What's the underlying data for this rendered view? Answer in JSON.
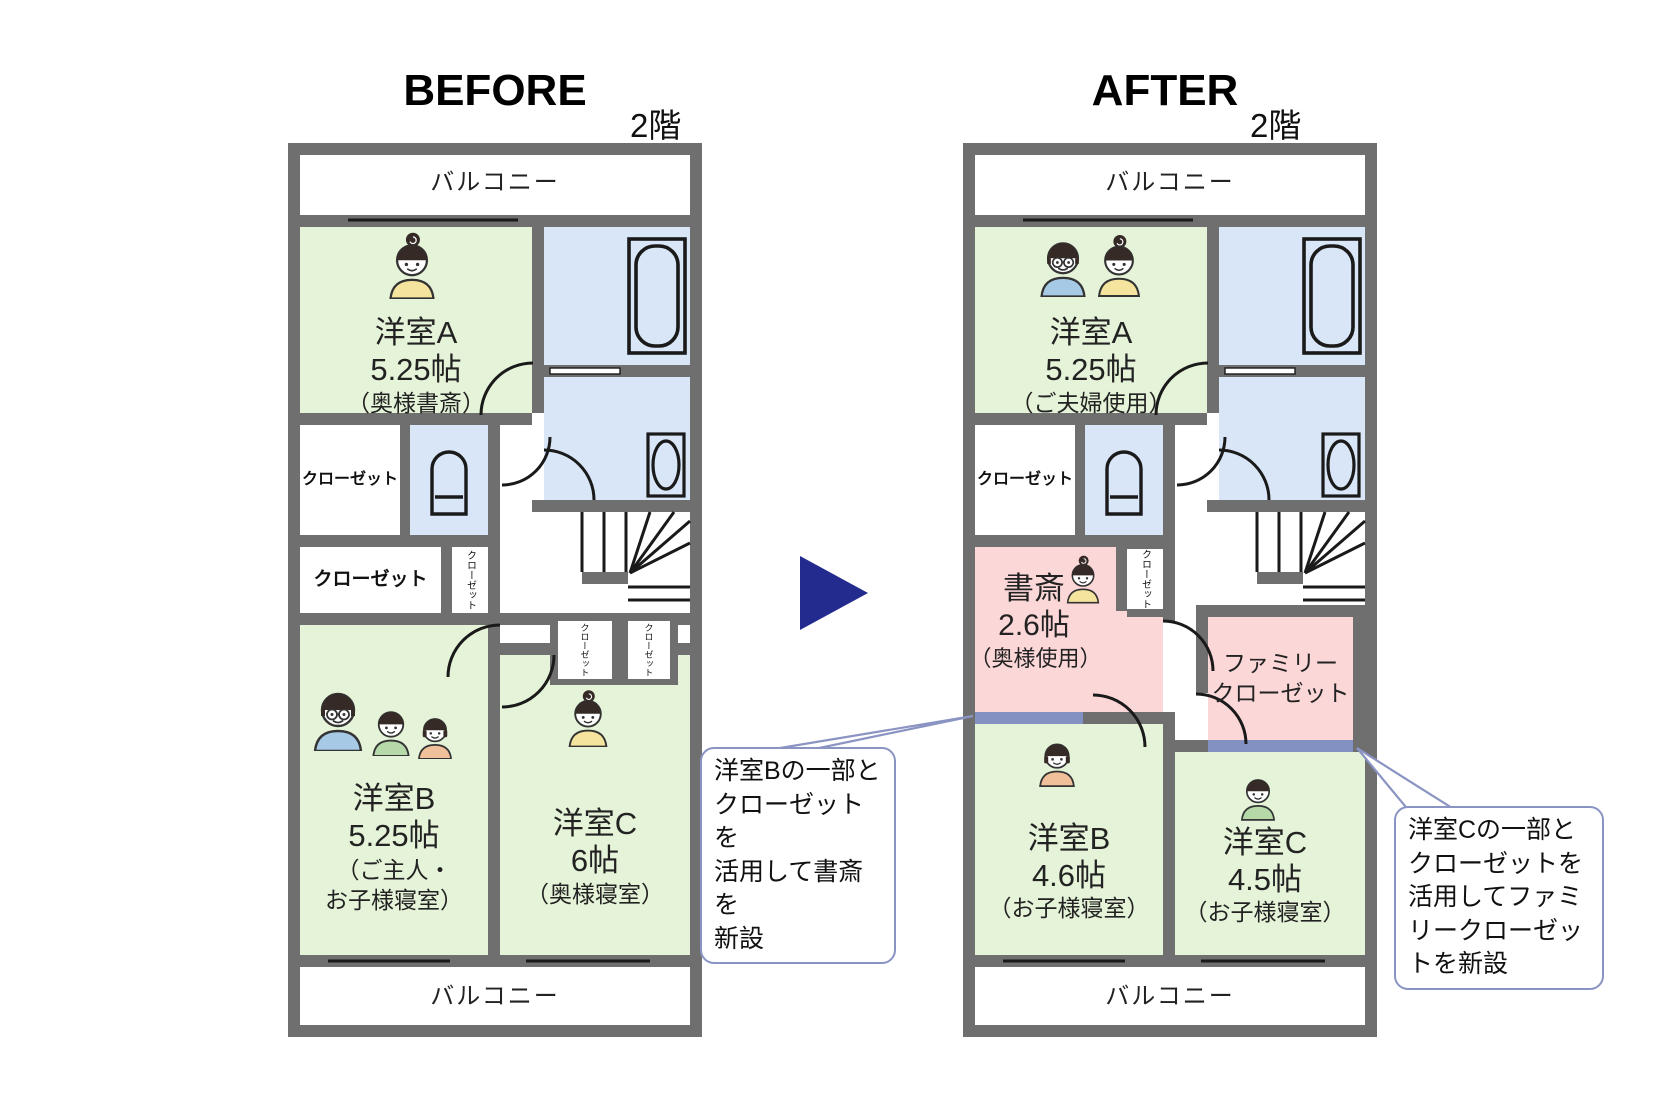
{
  "header": {
    "before_title": "BEFORE",
    "after_title": "AFTER",
    "floor_label_before": "2階",
    "floor_label_after": "2階"
  },
  "before": {
    "balcony_top": "バルコニー",
    "balcony_bottom": "バルコニー",
    "room_a_name": "洋室A",
    "room_a_size": "5.25帖",
    "room_a_note": "（奥様書斎）",
    "closet_upper": "クローゼット",
    "closet_lower": "クローゼット",
    "closet_hall": "クローゼット",
    "closet_c1": "クローゼット",
    "closet_c2": "クローゼット",
    "room_b_name": "洋室B",
    "room_b_size": "5.25帖",
    "room_b_note": "（ご主人・\nお子様寝室）",
    "room_c_name": "洋室C",
    "room_c_size": "6帖",
    "room_c_note": "（奥様寝室）"
  },
  "after": {
    "balcony_top": "バルコニー",
    "balcony_bottom": "バルコニー",
    "room_a_name": "洋室A",
    "room_a_size": "5.25帖",
    "room_a_note": "（ご夫婦使用）",
    "closet_upper": "クローゼット",
    "closet_hall": "クローゼット",
    "study_name": "書斎",
    "study_size": "2.6帖",
    "study_note": "（奥様使用）",
    "family_closet": "ファミリー\nクローゼット",
    "room_b_name": "洋室B",
    "room_b_size": "4.6帖",
    "room_b_note": "（お子様寝室）",
    "room_c_name": "洋室C",
    "room_c_size": "4.5帖",
    "room_c_note": "（お子様寝室）"
  },
  "callouts": {
    "left": "洋室Bの一部と\nクローゼットを\n活用して書斎を\n新設",
    "right": "洋室Cの一部と\nクローゼットを\n活用してファミ\nリークローゼッ\nトを新設"
  },
  "colors": {
    "room_green": "#e5f3d8",
    "water_blue": "#d9e6f7",
    "new_pink": "#fcd7d8",
    "wall_gray": "#6f6f6f",
    "new_wall_blue": "#8290c2",
    "arrow_navy": "#232c8e",
    "callout_border": "#8a94c2"
  }
}
